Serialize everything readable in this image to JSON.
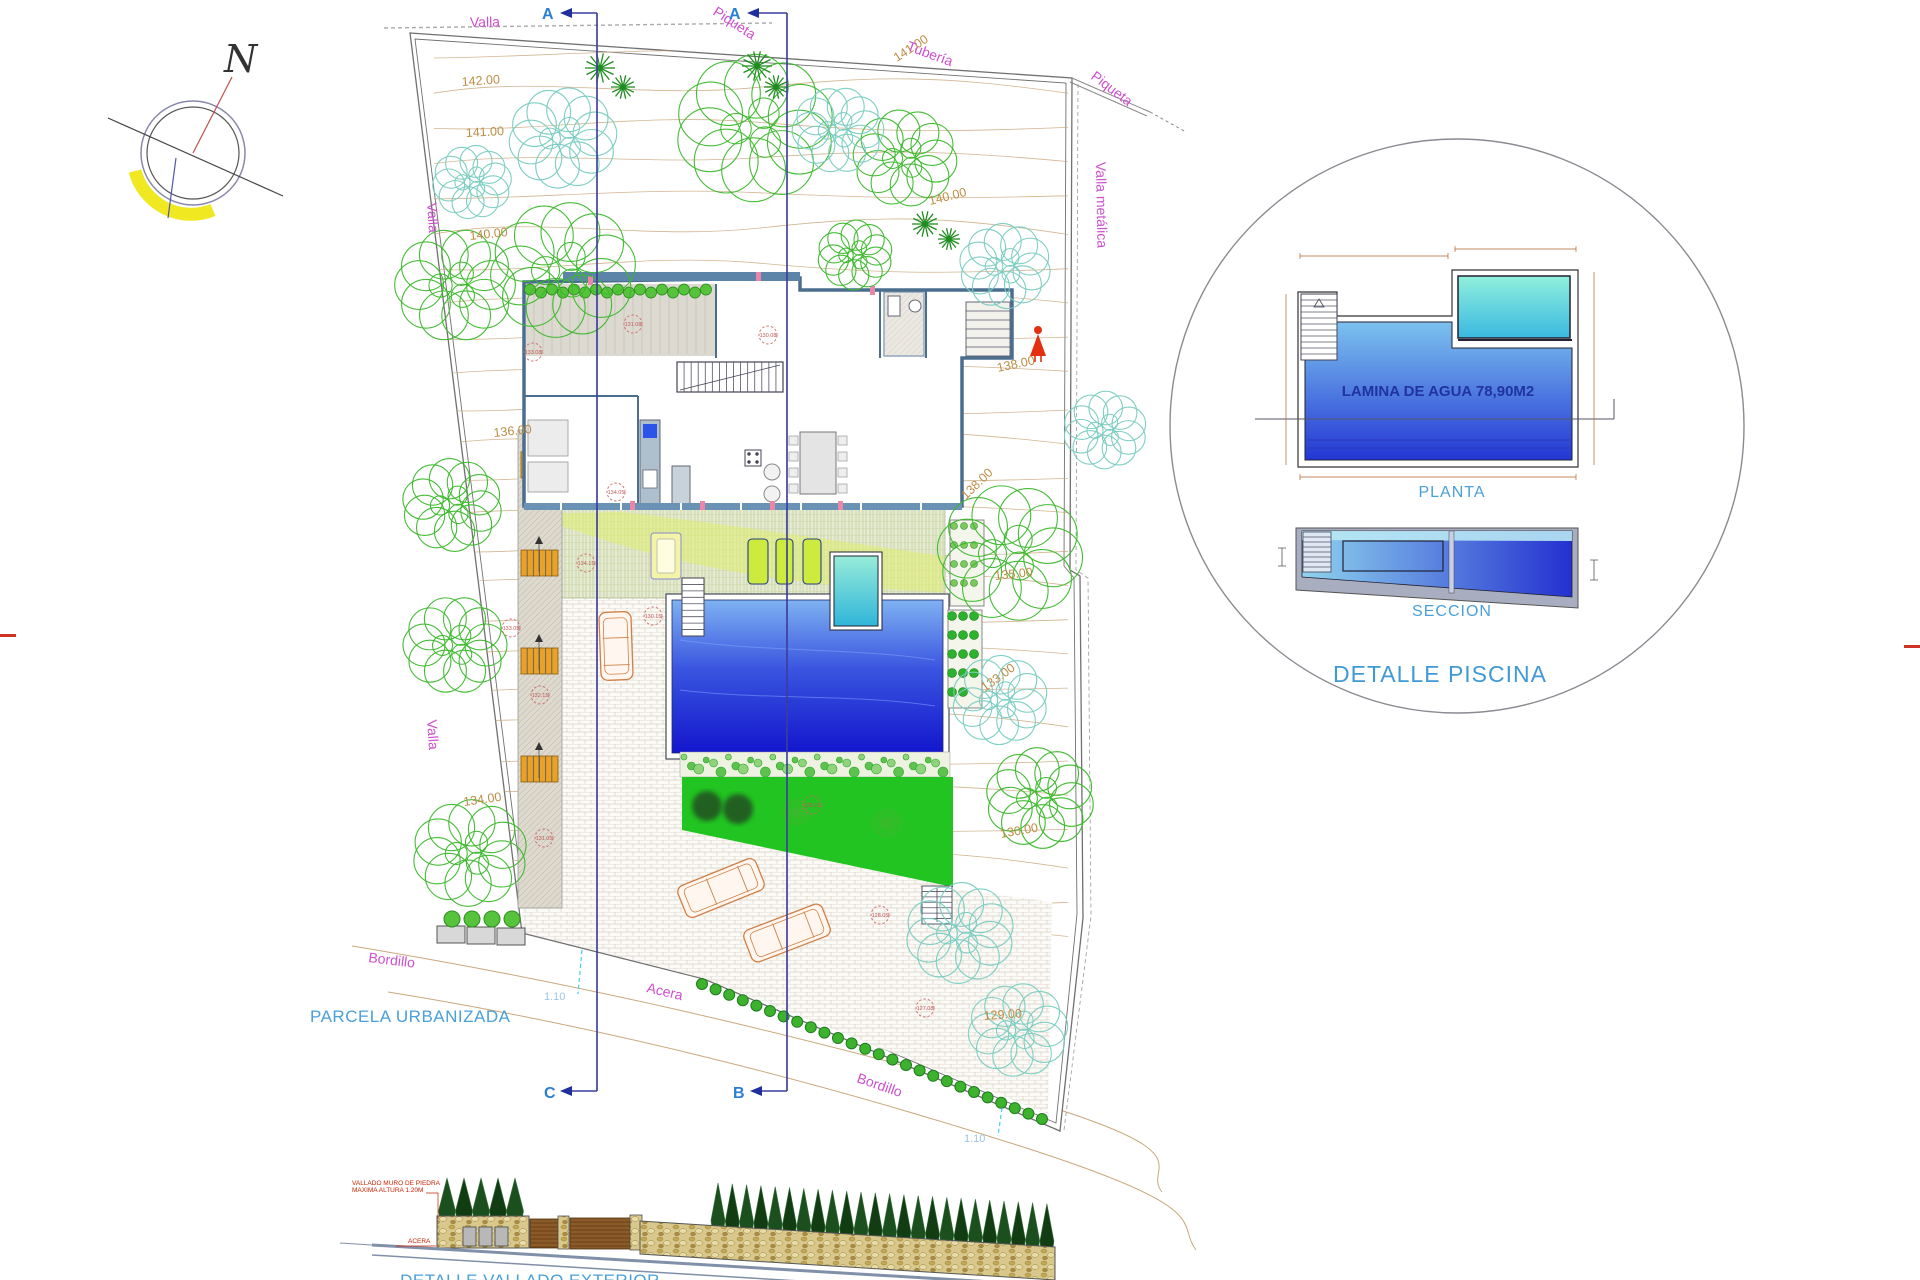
{
  "compass": {
    "north_label": "N"
  },
  "section_markers": {
    "top_left": "A",
    "top_right": "A",
    "bottom_left": "C",
    "bottom_right": "B"
  },
  "site_labels": {
    "valla_top": "Valla",
    "piqueta_top": "Piqueta",
    "tuberia": "Tubería",
    "piqueta_right": "Piqueta",
    "valla_metalica": "Valla metálica",
    "valla_left_upper": "Valla",
    "valla_left_lower": "Valla",
    "bordillo_left": "Bordillo",
    "acera_street": "Acera",
    "bordillo_bottom": "Bordillo",
    "parcela": "PARCELA URBANIZADA",
    "scale_note_left": "1.10",
    "scale_note_right": "1.10"
  },
  "contour_labels": [
    {
      "text": "142.00",
      "x": 462,
      "y": 86,
      "rot": -4
    },
    {
      "text": "141.00",
      "x": 466,
      "y": 137,
      "rot": -3
    },
    {
      "text": "141.00",
      "x": 897,
      "y": 62,
      "rot": -33
    },
    {
      "text": "140.00",
      "x": 930,
      "y": 205,
      "rot": -14
    },
    {
      "text": "140.00",
      "x": 470,
      "y": 240,
      "rot": -6
    },
    {
      "text": "138.00",
      "x": 998,
      "y": 372,
      "rot": -12
    },
    {
      "text": "138.00",
      "x": 966,
      "y": 500,
      "rot": -44
    },
    {
      "text": "136.00",
      "x": 494,
      "y": 437,
      "rot": -6
    },
    {
      "text": "135.00",
      "x": 995,
      "y": 580,
      "rot": -6
    },
    {
      "text": "134.00",
      "x": 464,
      "y": 806,
      "rot": -8
    },
    {
      "text": "133.00",
      "x": 985,
      "y": 692,
      "rot": -36
    },
    {
      "text": "130.00",
      "x": 1001,
      "y": 838,
      "rot": -10
    },
    {
      "text": "129.00",
      "x": 984,
      "y": 1020,
      "rot": -4
    }
  ],
  "spot_elevations": [
    {
      "text": "133.08",
      "x": 533,
      "y": 352
    },
    {
      "text": "131.08",
      "x": 633,
      "y": 324
    },
    {
      "text": "130.08",
      "x": 768,
      "y": 335
    },
    {
      "text": "134.05",
      "x": 616,
      "y": 492
    },
    {
      "text": "134.15",
      "x": 586,
      "y": 563
    },
    {
      "text": "133.05",
      "x": 511,
      "y": 628
    },
    {
      "text": "130.15",
      "x": 653,
      "y": 616
    },
    {
      "text": "132.15",
      "x": 540,
      "y": 695
    },
    {
      "text": "131.05",
      "x": 544,
      "y": 838
    },
    {
      "text": "128.15",
      "x": 812,
      "y": 805
    },
    {
      "text": "128.05",
      "x": 880,
      "y": 915
    },
    {
      "text": "127.08",
      "x": 925,
      "y": 1008
    }
  ],
  "detail_piscina": {
    "water_area_label": "LAMINA DE AGUA 78,90M2",
    "plan_label": "PLANTA",
    "section_label": "SECCION",
    "title": "DETALLE PISCINA"
  },
  "fence_detail": {
    "note_line1": "VALLADO MURO DE PIEDRA",
    "note_line2": "MAXIMA ALTURA 1.20M",
    "acera_label": "ACERA",
    "title": "DETALLE VALLADO EXTERIOR"
  },
  "colors": {
    "label_magenta": "#cf4fcf",
    "label_blue": "#4aa0d8",
    "contour_tan": "#bd8c44",
    "section_line_blue": "#3d3d9e",
    "spot_red": "#cc5858",
    "pool_deep": "#1216cc",
    "pool_light": "#7fb2f2",
    "lawn_green": "#21c421",
    "stair_orange": "#e8a228"
  }
}
